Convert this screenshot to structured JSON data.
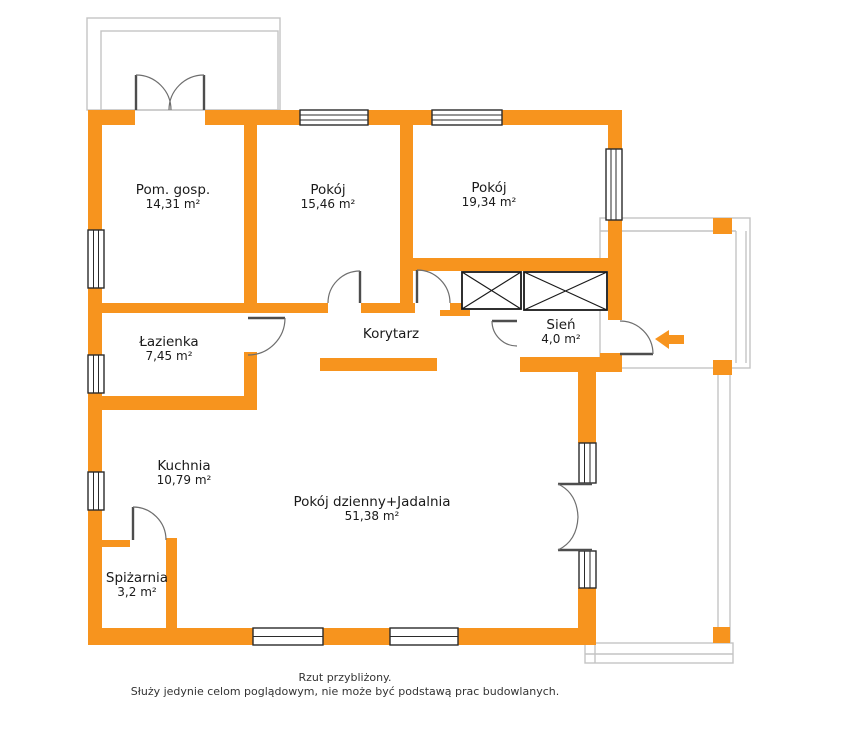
{
  "title": "Rzut mieszkania",
  "colors": {
    "wall_orange": "#F7941E",
    "terrace_outline_gray": "#C4C4C4",
    "door_gray": "#4D4D4D",
    "window_frame_dark": "#2B2B2B",
    "text_dark": "#1A1A1A"
  },
  "icons": {
    "entrance_arrow": "left-arrow"
  },
  "rooms": [
    {
      "id": "pom-gosp",
      "name": "Pom. gosp.",
      "area": "14,31 m²"
    },
    {
      "id": "pokoj-1",
      "name": "Pokój",
      "area": "15,46 m²"
    },
    {
      "id": "pokoj-2",
      "name": "Pokój",
      "area": "19,34 m²"
    },
    {
      "id": "lazienka",
      "name": "Łazienka",
      "area": "7,45 m²"
    },
    {
      "id": "korytarz",
      "name": "Korytarz",
      "area": ""
    },
    {
      "id": "sien",
      "name": "Sień",
      "area": "4,0 m²"
    },
    {
      "id": "kuchnia",
      "name": "Kuchnia",
      "area": "10,79 m²"
    },
    {
      "id": "pokoj-dzienny",
      "name": "Pokój dzienny+Jadalnia",
      "area": "51,38 m²"
    },
    {
      "id": "spizarnia",
      "name": "Spiżarnia",
      "area": "3,2 m²"
    }
  ],
  "footer": {
    "line1": "Rzut przybliżony.",
    "line2": "Służy jedynie celom poglądowym, nie może być podstawą prac budowlanych."
  }
}
